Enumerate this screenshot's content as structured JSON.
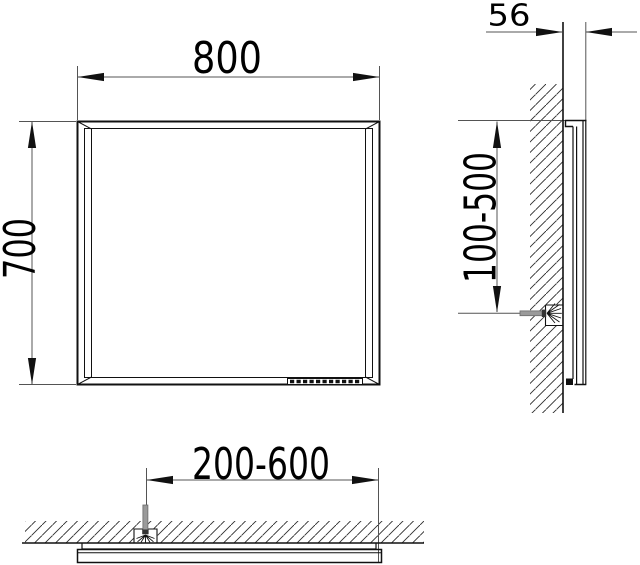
{
  "drawing": {
    "type": "technical-dimension-drawing",
    "subject": "wall-mounted mirror installation drawing",
    "dimensions": {
      "front_width": "800",
      "front_height": "700",
      "side_depth": "56",
      "side_mount_height": "100-500",
      "plan_cable_range": "200-600"
    },
    "colors": {
      "object_line": "#111111",
      "dimension_line": "#545454",
      "hatch_line": "#2b2b2b",
      "cable_gray": "#9a9a9a",
      "label_text": "#000000",
      "background": "#ffffff"
    }
  }
}
